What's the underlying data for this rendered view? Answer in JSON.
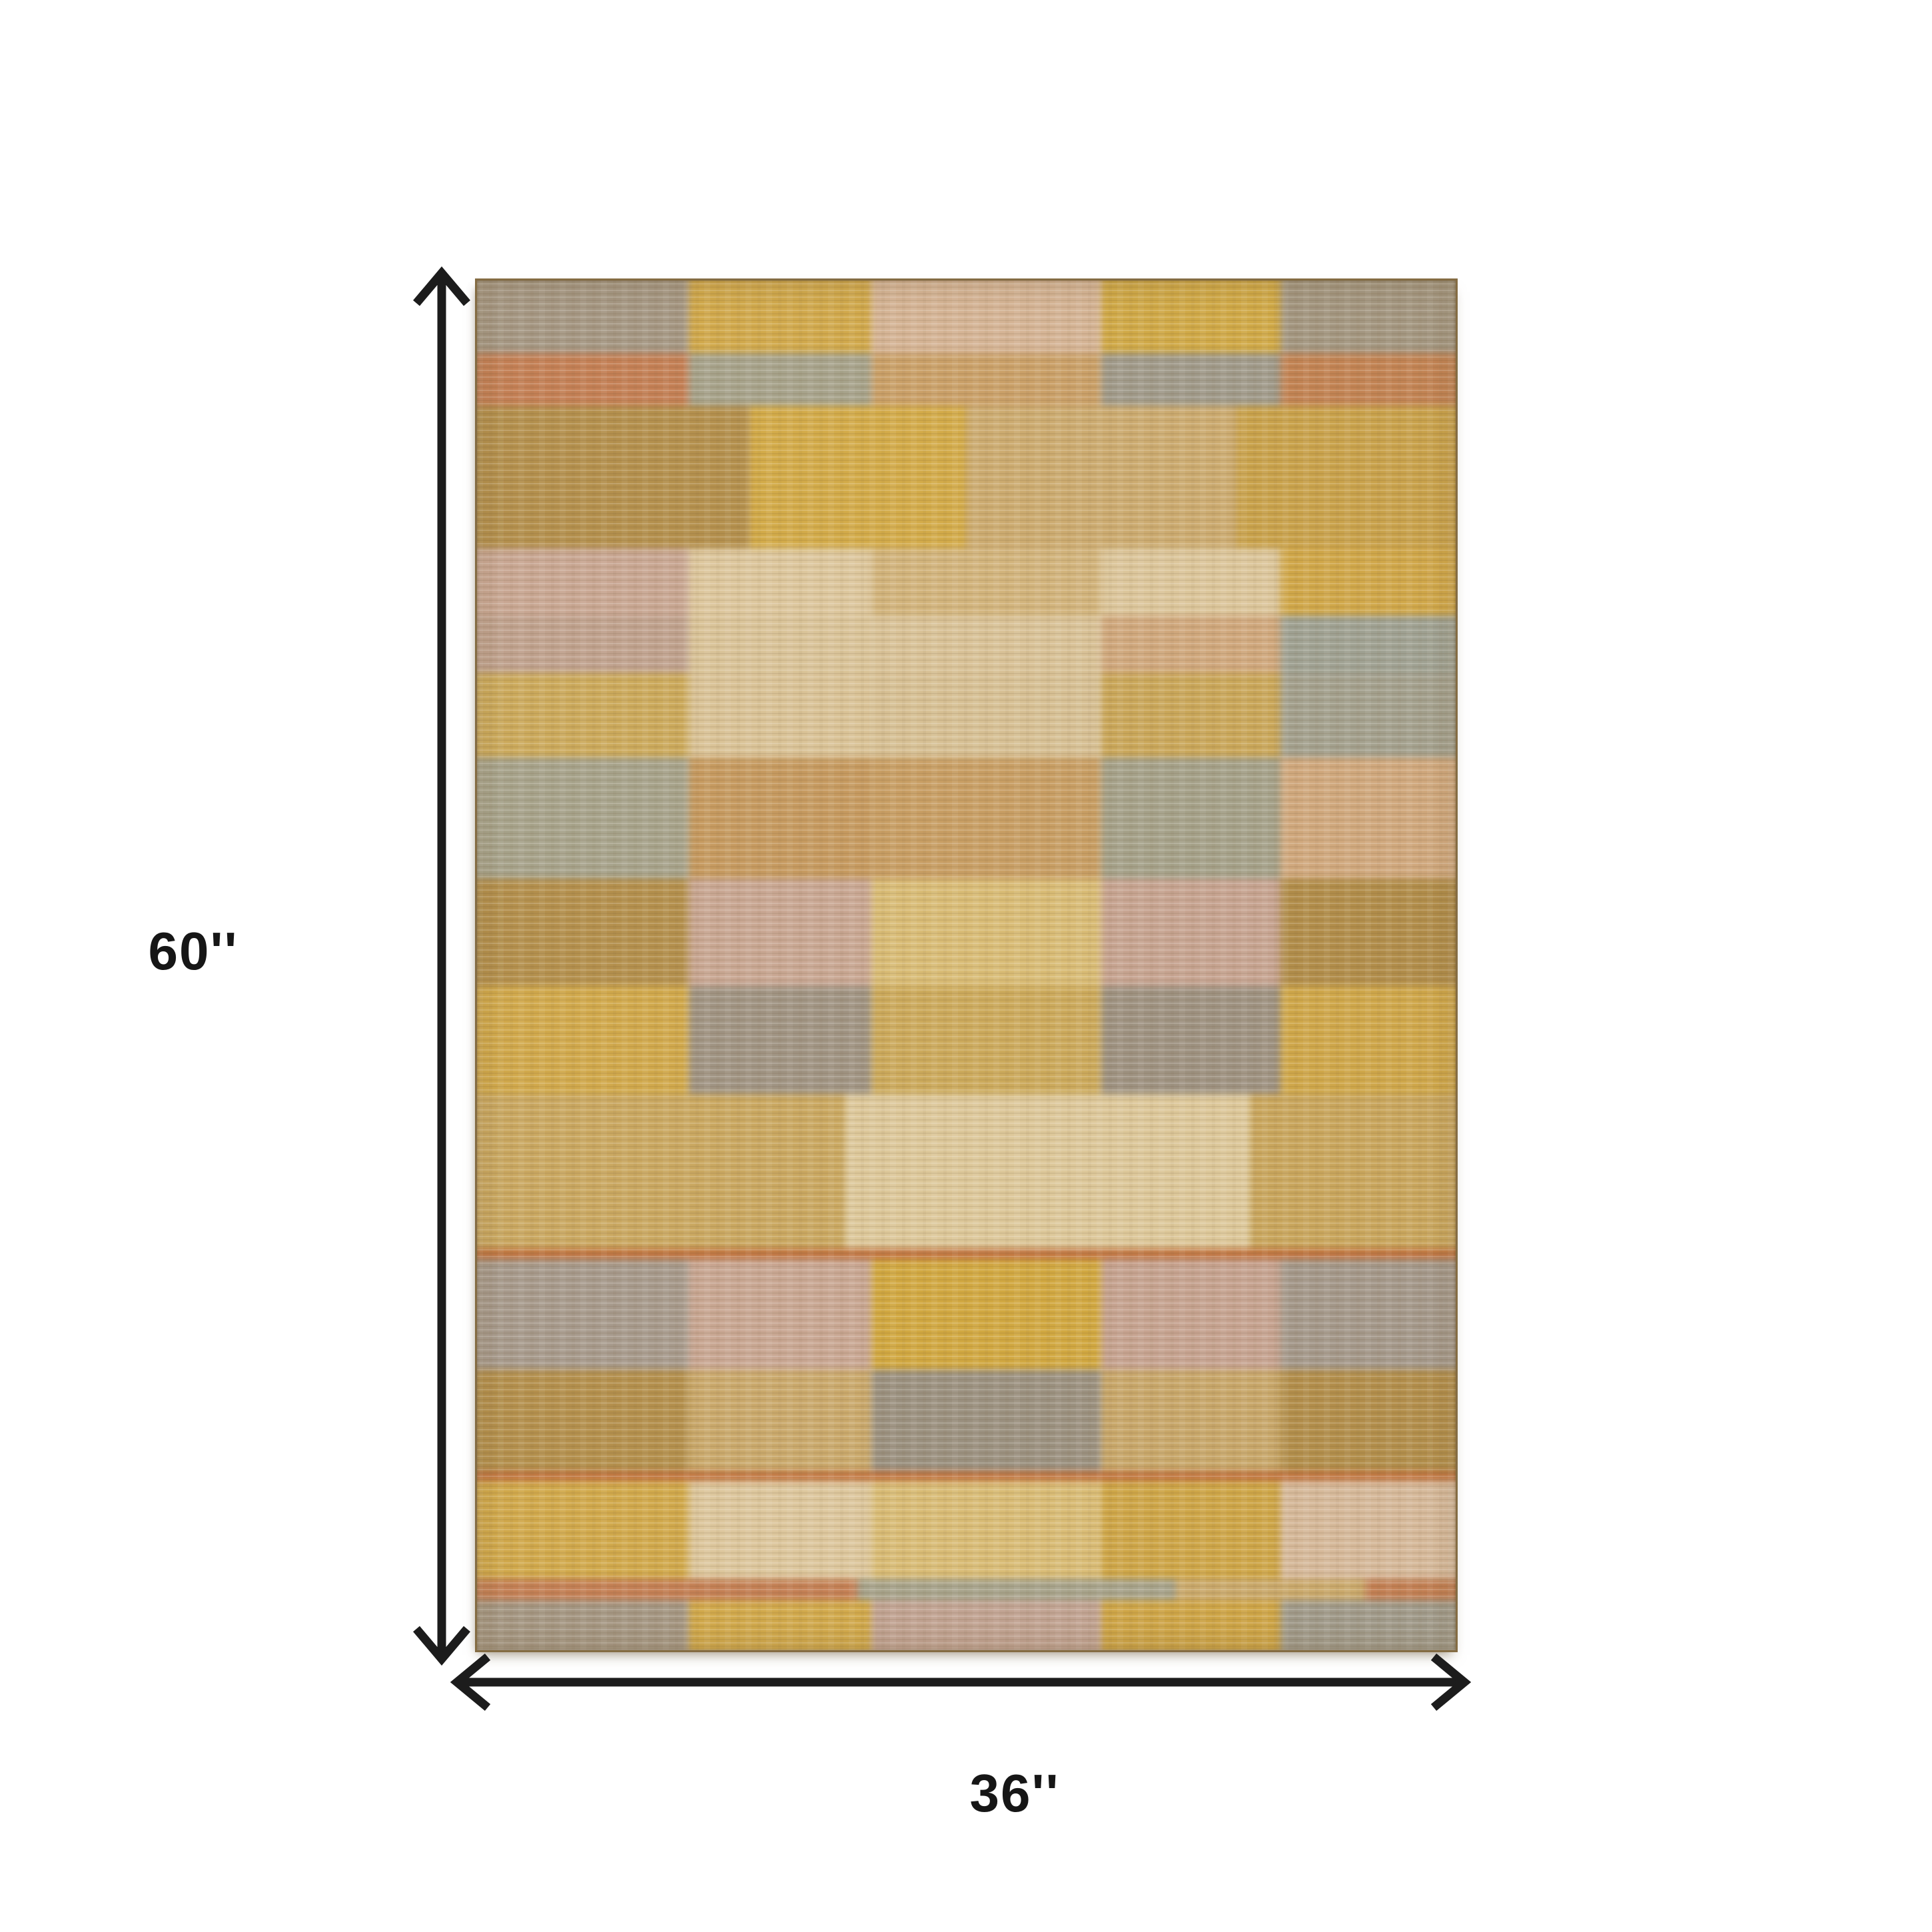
{
  "page": {
    "background": "#ffffff"
  },
  "dimensions": {
    "height": "60''",
    "width": "36''"
  },
  "arrow": {
    "color": "#1c1c1c",
    "stroke_width": 13
  },
  "rug": {
    "border_color": "#604b2c",
    "palette": {
      "taupe": "#a59784",
      "gold": "#d0a94f",
      "blush": "#d4b496",
      "rust": "#c28057",
      "sage": "#a7a38c",
      "tan": "#c9a96e",
      "gray": "#a09a8a",
      "camel": "#b3904f",
      "cream": "#dcc79e",
      "pink_mauve": "#c8a794",
      "gray_mauve": "#a79a8c",
      "peach": "#cfa87e",
      "gold_tan": "#cbaa5e",
      "pale_gold": "#d8bc78",
      "gray_brown": "#9b9181",
      "mauve": "#c0a393",
      "orange_line": "#bf7442"
    },
    "rows": [
      {
        "h": 0.0592,
        "blocks": [
          {
            "w": 0.2217,
            "c": "#a59784"
          },
          {
            "w": 0.1831,
            "c": "#d0a94f"
          },
          {
            "w": 0.2305,
            "c": "#d4b496"
          },
          {
            "w": 0.1797,
            "c": "#cfa94a"
          },
          {
            "w": 0.1851,
            "c": "#a39681"
          }
        ]
      },
      {
        "h": 0.0378,
        "blocks": [
          {
            "w": 0.2217,
            "c": "#c28057"
          },
          {
            "w": 0.1831,
            "c": "#a7a38c"
          },
          {
            "w": 0.2305,
            "c": "#c9a06a"
          },
          {
            "w": 0.1797,
            "c": "#a09a8a"
          },
          {
            "w": 0.1851,
            "c": "#c08355"
          }
        ]
      },
      {
        "h": 0.1028,
        "blocks": [
          {
            "w": 0.283,
            "c": "#b3904f"
          },
          {
            "w": 0.217,
            "c": "#d2ab4c"
          },
          {
            "w": 0.271,
            "c": "#cbab72"
          },
          {
            "w": 0.229,
            "c": "#c8a24e"
          }
        ]
      },
      {
        "h": 0.0485,
        "blocks": [
          {
            "w": 0.2217,
            "c": "#c8a794"
          },
          {
            "w": 0.1831,
            "c": "#dcc79e"
          },
          {
            "w": 0.2305,
            "c": "#d1b47e"
          },
          {
            "w": 0.1797,
            "c": "#dbc69c"
          },
          {
            "w": 0.1851,
            "c": "#cfa74c"
          }
        ]
      },
      {
        "h": 0.0412,
        "blocks": [
          {
            "w": 0.2217,
            "c": "#bfa28f"
          },
          {
            "w": 0.1831,
            "c": "#d9c49a"
          },
          {
            "w": 0.2305,
            "c": "#d8c298"
          },
          {
            "w": 0.1797,
            "c": "#cfa87e"
          },
          {
            "w": 0.1851,
            "c": "#9fa192"
          }
        ]
      },
      {
        "h": 0.0606,
        "blocks": [
          {
            "w": 0.2217,
            "c": "#cbaa5e"
          },
          {
            "w": 0.1831,
            "c": "#d9c398"
          },
          {
            "w": 0.2305,
            "c": "#d6c095"
          },
          {
            "w": 0.1797,
            "c": "#c9a75c"
          },
          {
            "w": 0.1851,
            "c": "#a3a08e"
          }
        ]
      },
      {
        "h": 0.0873,
        "blocks": [
          {
            "w": 0.2217,
            "c": "#a7a38c"
          },
          {
            "w": 0.1831,
            "c": "#c59a62"
          },
          {
            "w": 0.2305,
            "c": "#c79e66"
          },
          {
            "w": 0.1797,
            "c": "#a5a18a"
          },
          {
            "w": 0.1851,
            "c": "#cfa87e"
          }
        ]
      },
      {
        "h": 0.0776,
        "blocks": [
          {
            "w": 0.2217,
            "c": "#b3904f"
          },
          {
            "w": 0.1831,
            "c": "#c8a794"
          },
          {
            "w": 0.2305,
            "c": "#d8bc78"
          },
          {
            "w": 0.1797,
            "c": "#c6a492"
          },
          {
            "w": 0.1851,
            "c": "#b08d4c"
          }
        ]
      },
      {
        "h": 0.0776,
        "blocks": [
          {
            "w": 0.2217,
            "c": "#d0a94f"
          },
          {
            "w": 0.1831,
            "c": "#a09484"
          },
          {
            "w": 0.2305,
            "c": "#cbaa5e"
          },
          {
            "w": 0.1797,
            "c": "#9e9282"
          },
          {
            "w": 0.1851,
            "c": "#cea74d"
          }
        ]
      },
      {
        "h": 0.1115,
        "blocks": [
          {
            "w": 0.378,
            "c": "#c9a863"
          },
          {
            "w": 0.407,
            "c": "#dcc89b"
          },
          {
            "w": 0.215,
            "c": "#c8a65f"
          }
        ]
      },
      {
        "h": 0.0073,
        "blocks": [
          {
            "w": 1.0,
            "c": "#bf7442"
          }
        ]
      },
      {
        "h": 0.08,
        "blocks": [
          {
            "w": 0.2217,
            "c": "#a79a8c"
          },
          {
            "w": 0.1831,
            "c": "#c8a794"
          },
          {
            "w": 0.2305,
            "c": "#d0a844"
          },
          {
            "w": 0.1797,
            "c": "#c5a391"
          },
          {
            "w": 0.1851,
            "c": "#a4988a"
          }
        ]
      },
      {
        "h": 0.0728,
        "blocks": [
          {
            "w": 0.2217,
            "c": "#b3904f"
          },
          {
            "w": 0.1831,
            "c": "#c9a96e"
          },
          {
            "w": 0.2305,
            "c": "#9b9181"
          },
          {
            "w": 0.1797,
            "c": "#c7a76c"
          },
          {
            "w": 0.1851,
            "c": "#b18e4d"
          }
        ]
      },
      {
        "h": 0.0073,
        "blocks": [
          {
            "w": 1.0,
            "c": "#bf7442"
          }
        ]
      },
      {
        "h": 0.0703,
        "blocks": [
          {
            "w": 0.2217,
            "c": "#d0a94f"
          },
          {
            "w": 0.1831,
            "c": "#dcc79e"
          },
          {
            "w": 0.2305,
            "c": "#d8bc78"
          },
          {
            "w": 0.1797,
            "c": "#cda64b"
          },
          {
            "w": 0.1851,
            "c": "#d5b99b"
          }
        ]
      },
      {
        "h": 0.0155,
        "blocks": [
          {
            "w": 0.391,
            "c": "#c28057"
          },
          {
            "w": 0.319,
            "c": "#a7a38c"
          },
          {
            "w": 0.19,
            "c": "#c9a96e"
          },
          {
            "w": 0.1,
            "c": "#c07f55"
          }
        ]
      },
      {
        "h": 0.0427,
        "blocks": [
          {
            "w": 0.2217,
            "c": "#a59784"
          },
          {
            "w": 0.1831,
            "c": "#d0a94f"
          },
          {
            "w": 0.2305,
            "c": "#c0a393"
          },
          {
            "w": 0.1797,
            "c": "#cda54a"
          },
          {
            "w": 0.1851,
            "c": "#a09a8a"
          }
        ]
      }
    ]
  }
}
